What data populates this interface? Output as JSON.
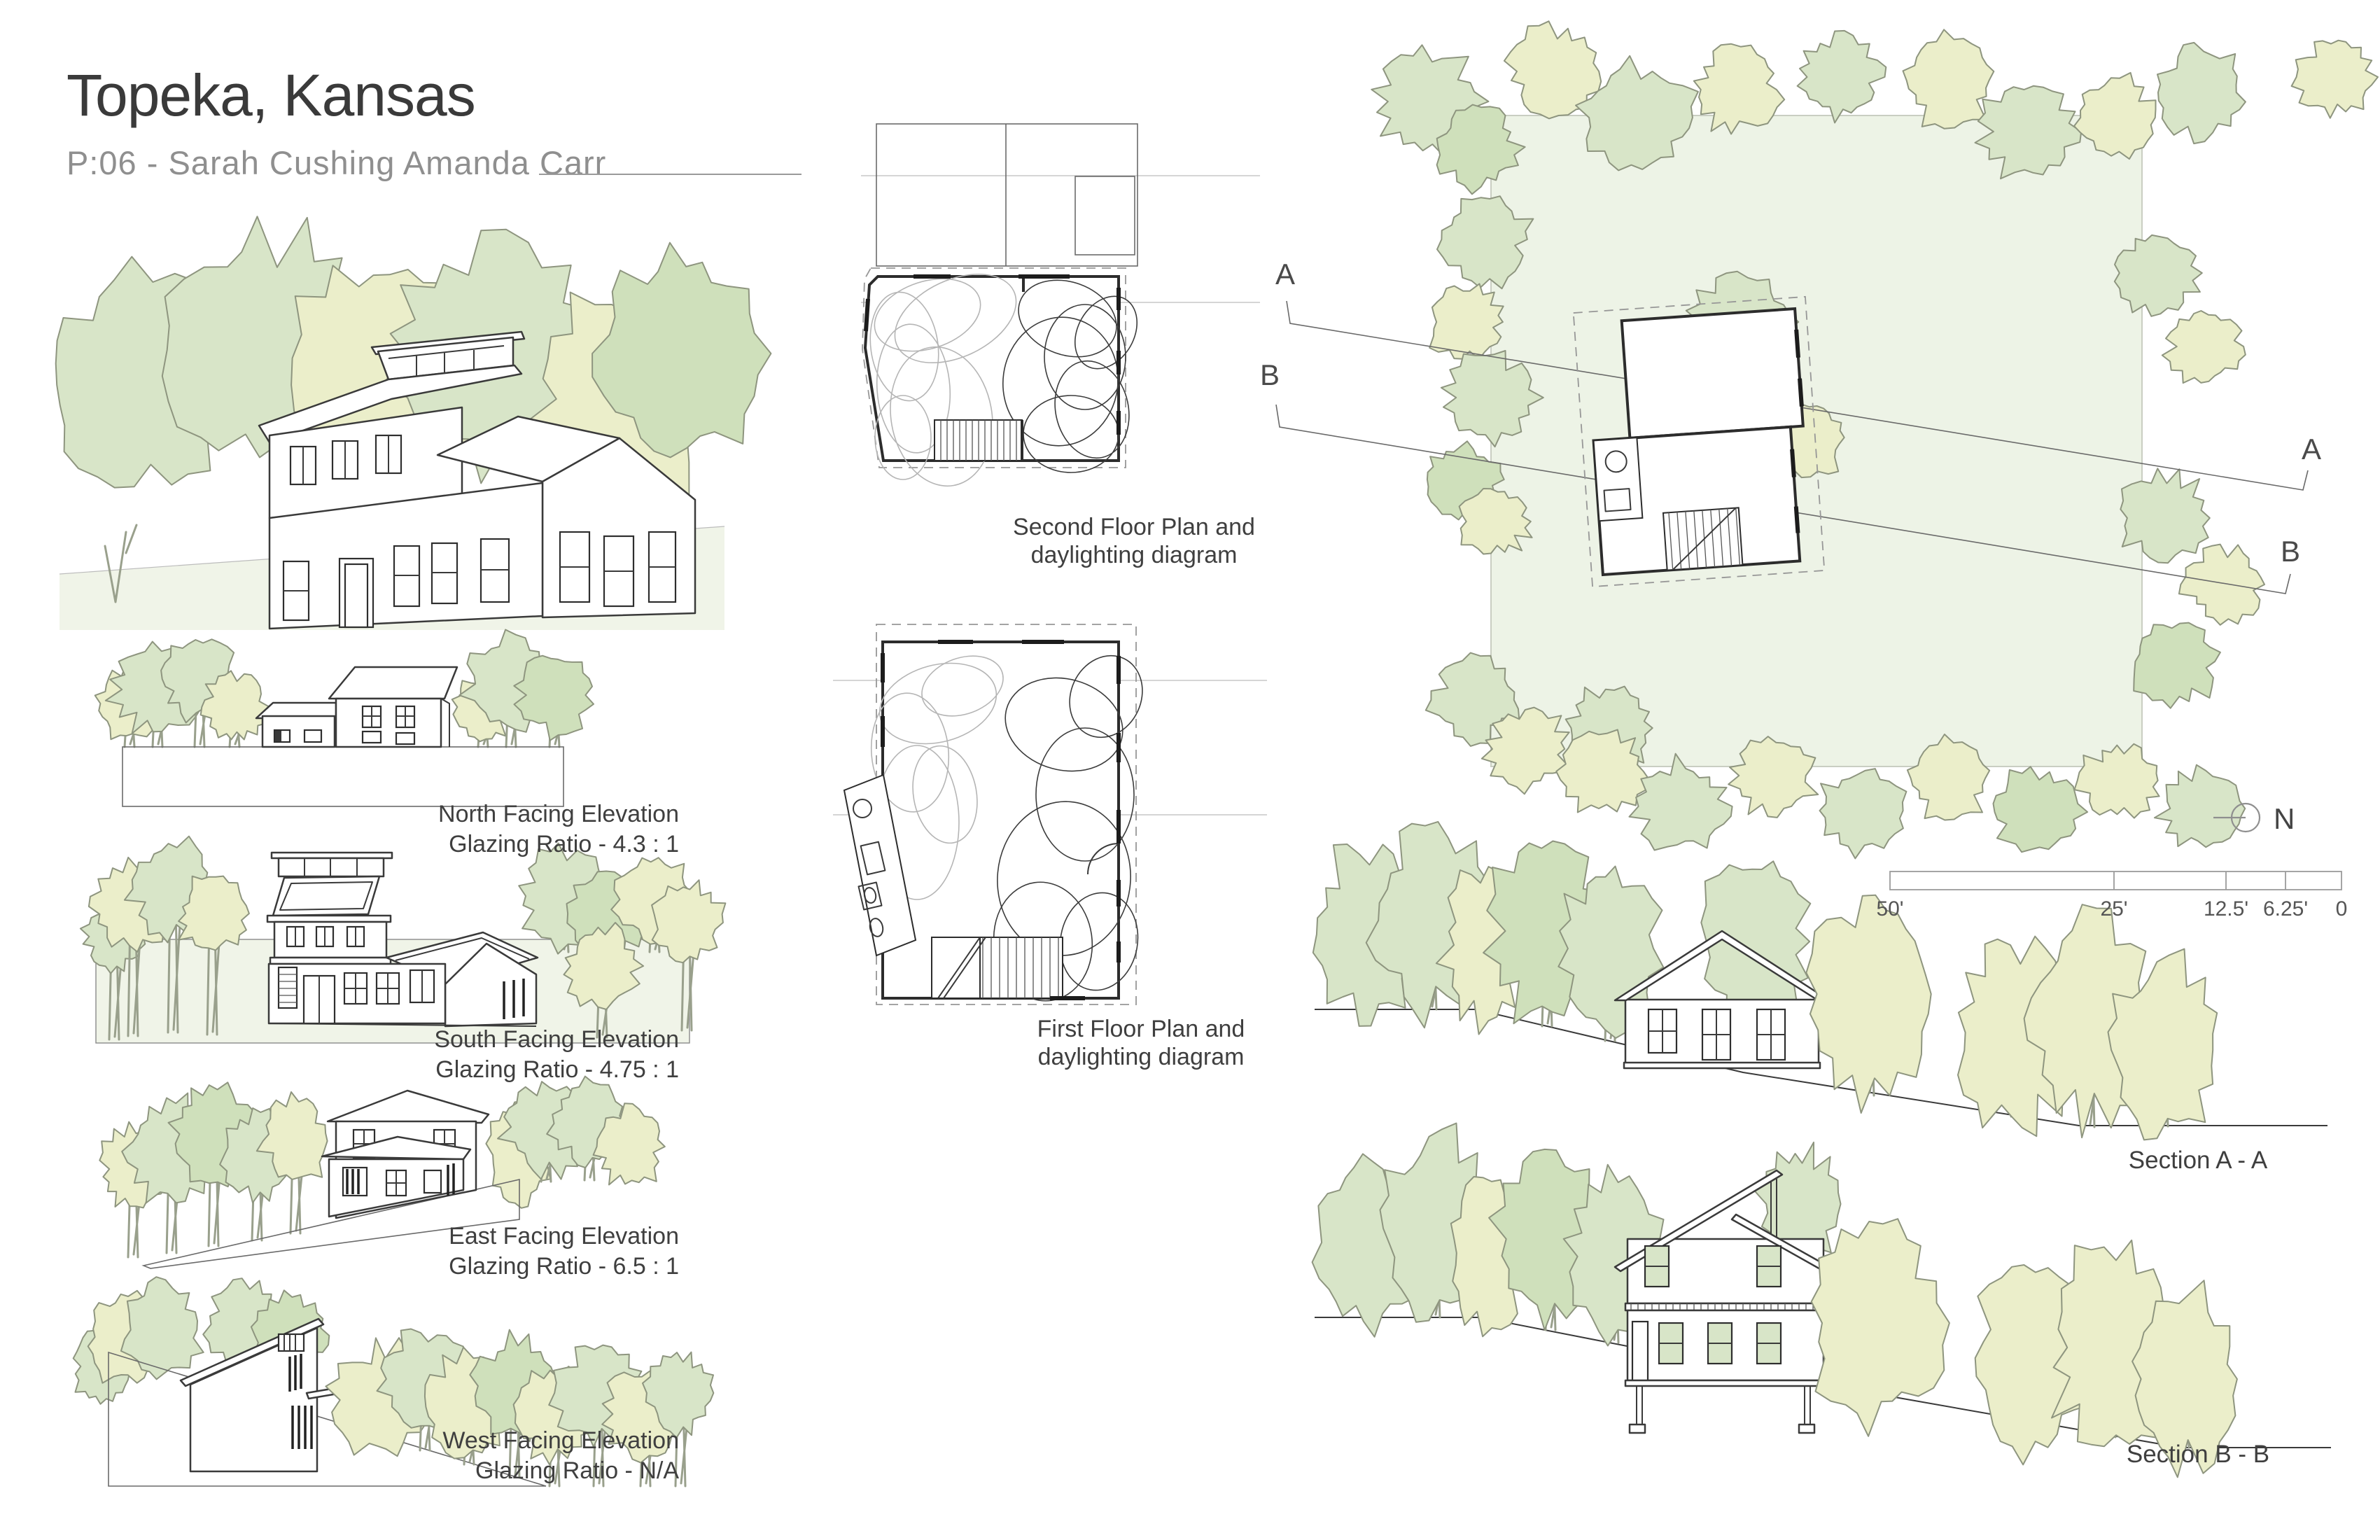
{
  "title": "Topeka, Kansas",
  "subtitle": "P:06 - Sarah Cushing Amanda Carr",
  "elevations": [
    {
      "name": "North Facing Elevation",
      "ratio": "Glazing Ratio - 4.3 : 1"
    },
    {
      "name": "South Facing Elevation",
      "ratio": "Glazing Ratio - 4.75 : 1"
    },
    {
      "name": "East Facing Elevation",
      "ratio": "Glazing Ratio - 6.5 : 1"
    },
    {
      "name": "West Facing Elevation",
      "ratio": "Glazing Ratio - N/A"
    }
  ],
  "plans": [
    {
      "line1": "Second Floor Plan and",
      "line2": "daylighting diagram"
    },
    {
      "line1": "First Floor Plan and",
      "line2": "daylighting diagram"
    }
  ],
  "sections": [
    {
      "label": "Section A - A"
    },
    {
      "label": "Section B - B"
    }
  ],
  "site": {
    "marker_a": "A",
    "marker_b": "B",
    "north_label": "N",
    "scale_labels": [
      "50'",
      "25'",
      "12.5'",
      "6.25'",
      "0"
    ]
  },
  "colors": {
    "ink": "#3a3a3a",
    "text": "#3f3f3f",
    "subtitle": "#8f8f8f",
    "tree_green": "#d8e5c8",
    "tree_green2": "#cfe0bb",
    "tree_yellow": "#ebeeca",
    "tree_outline": "#8e957f",
    "site_fill": "#edf3e6",
    "ground_tint": "#f0f4e8"
  }
}
